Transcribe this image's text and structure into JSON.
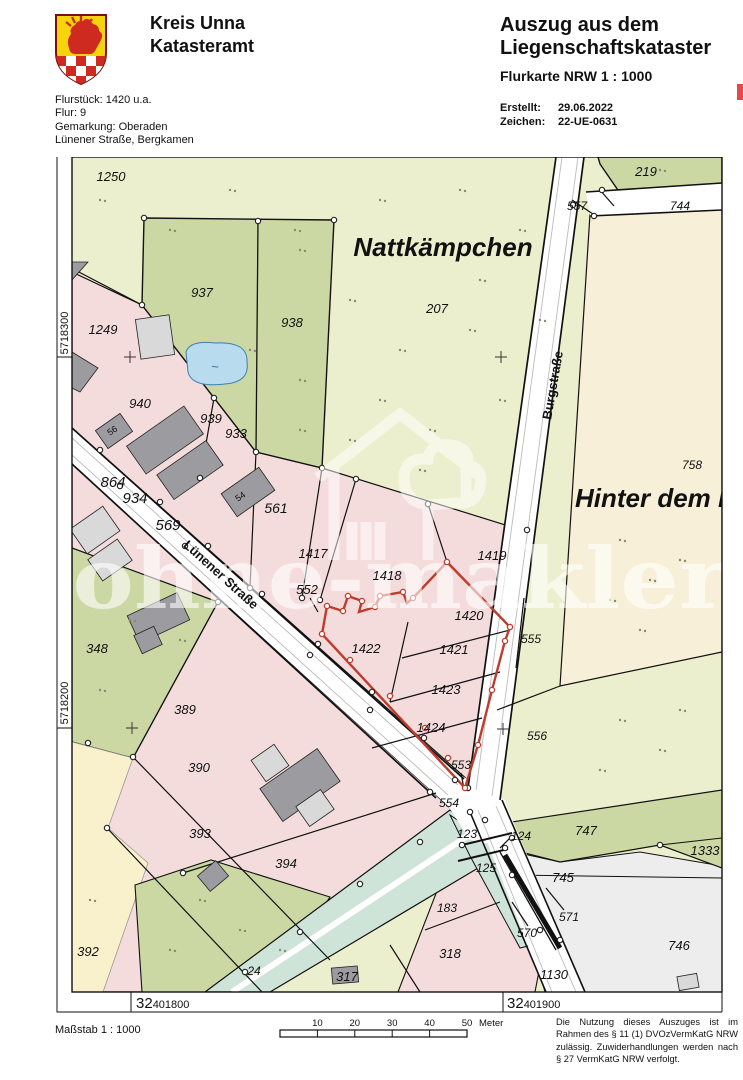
{
  "header": {
    "org_line1": "Kreis Unna",
    "org_line2": "Katasteramt",
    "info_lines": [
      "Flurstück: 1420 u.a.",
      "Flur: 9",
      "Gemarkung: Oberaden",
      "Lünener Straße, Bergkamen"
    ],
    "title_line1": "Auszug aus dem",
    "title_line2": "Liegenschaftskataster",
    "subtitle": "Flurkarte NRW 1 : 1000",
    "created_label": "Erstellt:",
    "created_value": "29.06.2022",
    "ref_label": "Zeichen:",
    "ref_value": "22-UE-0631"
  },
  "map": {
    "watermark_text": "ohne-makler",
    "labels": [
      {
        "t": "1250",
        "x": 111,
        "y": 181
      },
      {
        "t": "937",
        "x": 202,
        "y": 297
      },
      {
        "t": "938",
        "x": 292,
        "y": 327
      },
      {
        "t": "207",
        "x": 437,
        "y": 313
      },
      {
        "t": "Nattkämpchen",
        "x": 443,
        "y": 256,
        "s": 26,
        "b": 1
      },
      {
        "t": "219",
        "x": 646,
        "y": 176
      },
      {
        "t": "744",
        "x": 680,
        "y": 210,
        "s": 12
      },
      {
        "t": "557",
        "x": 577,
        "y": 210,
        "s": 12
      },
      {
        "t": "758",
        "x": 692,
        "y": 469,
        "s": 12
      },
      {
        "t": "Hinter dem B",
        "x": 575,
        "y": 507,
        "s": 26,
        "b": 1,
        "a": "start"
      },
      {
        "t": "Burgstraße",
        "x": 557,
        "y": 386,
        "s": 13,
        "b": 1,
        "i": 0,
        "r": -80
      },
      {
        "t": "Lünener Straße",
        "x": 218,
        "y": 578,
        "s": 13,
        "b": 1,
        "i": 0,
        "r": 42
      },
      {
        "t": "1249",
        "x": 103,
        "y": 334
      },
      {
        "t": "940",
        "x": 140,
        "y": 408
      },
      {
        "t": "939",
        "x": 211,
        "y": 423
      },
      {
        "t": "933",
        "x": 236,
        "y": 438
      },
      {
        "t": "864",
        "x": 113,
        "y": 487,
        "s": 15
      },
      {
        "t": "934",
        "x": 135,
        "y": 503,
        "s": 15
      },
      {
        "t": "569",
        "x": 168,
        "y": 530,
        "s": 15
      },
      {
        "t": "561",
        "x": 276,
        "y": 513,
        "s": 14
      },
      {
        "t": "56",
        "x": 114,
        "y": 433,
        "s": 9,
        "i": 0,
        "r": -35
      },
      {
        "t": "54",
        "x": 242,
        "y": 499,
        "s": 9,
        "i": 0,
        "r": -35
      },
      {
        "t": "1417",
        "x": 313,
        "y": 558
      },
      {
        "t": "1418",
        "x": 387,
        "y": 580
      },
      {
        "t": "552",
        "x": 307,
        "y": 594
      },
      {
        "t": "1419",
        "x": 492,
        "y": 560
      },
      {
        "t": "1420",
        "x": 469,
        "y": 620
      },
      {
        "t": "555",
        "x": 531,
        "y": 643,
        "s": 12
      },
      {
        "t": "1421",
        "x": 454,
        "y": 654
      },
      {
        "t": "1422",
        "x": 366,
        "y": 653
      },
      {
        "t": "1423",
        "x": 446,
        "y": 694
      },
      {
        "t": "1424",
        "x": 431,
        "y": 732
      },
      {
        "t": "556",
        "x": 537,
        "y": 740,
        "s": 12
      },
      {
        "t": "553",
        "x": 461,
        "y": 769,
        "s": 12
      },
      {
        "t": "554",
        "x": 449,
        "y": 807,
        "s": 12
      },
      {
        "t": "348",
        "x": 97,
        "y": 653
      },
      {
        "t": "389",
        "x": 185,
        "y": 714
      },
      {
        "t": "390",
        "x": 199,
        "y": 772
      },
      {
        "t": "393",
        "x": 200,
        "y": 838
      },
      {
        "t": "394",
        "x": 286,
        "y": 868
      },
      {
        "t": "392",
        "x": 88,
        "y": 956
      },
      {
        "t": "24",
        "x": 254,
        "y": 975,
        "s": 12
      },
      {
        "t": "317",
        "x": 347,
        "y": 981
      },
      {
        "t": "318",
        "x": 450,
        "y": 958
      },
      {
        "t": "183",
        "x": 447,
        "y": 912,
        "s": 12
      },
      {
        "t": "123",
        "x": 467,
        "y": 838,
        "s": 12
      },
      {
        "t": "124",
        "x": 521,
        "y": 840,
        "s": 12
      },
      {
        "t": "125",
        "x": 486,
        "y": 872,
        "s": 12
      },
      {
        "t": "747",
        "x": 586,
        "y": 835
      },
      {
        "t": "1333",
        "x": 705,
        "y": 855
      },
      {
        "t": "745",
        "x": 563,
        "y": 882
      },
      {
        "t": "570",
        "x": 527,
        "y": 937,
        "s": 12
      },
      {
        "t": "571",
        "x": 569,
        "y": 921,
        "s": 12
      },
      {
        "t": "746",
        "x": 679,
        "y": 950
      },
      {
        "t": "1130",
        "x": 554,
        "y": 979
      }
    ],
    "grid": {
      "left_labels": [
        {
          "t": "5718300",
          "y": 333
        },
        {
          "t": "5718200",
          "y": 703
        }
      ],
      "bottom_labels": [
        {
          "big": "32",
          "small": "401800",
          "x": 136
        },
        {
          "big": "32",
          "small": "401900",
          "x": 507
        }
      ]
    }
  },
  "footer": {
    "scale_label": "Maßstab 1 : 1000",
    "scale_ticks": [
      "10",
      "20",
      "30",
      "40",
      "50"
    ],
    "scale_unit": "Meter",
    "legal_text": "Die Nutzung dieses Auszuges ist im Rahmen des § 11 (1) DVOzVermKatG NRW zulässig. Zuwiderhandlungen werden nach § 27 VermKatG NRW verfolgt."
  },
  "colors": {
    "field": "#ecefcd",
    "meadow": "#ccd8a4",
    "residential": "#f4dcdc",
    "cream": "#f7efd8",
    "pale_yellow": "#f8f1cc",
    "water": "#b8dcee",
    "stream": "#cfe4d8",
    "building": "#9c9ca0",
    "highlight_red": "#bf3b2b"
  }
}
